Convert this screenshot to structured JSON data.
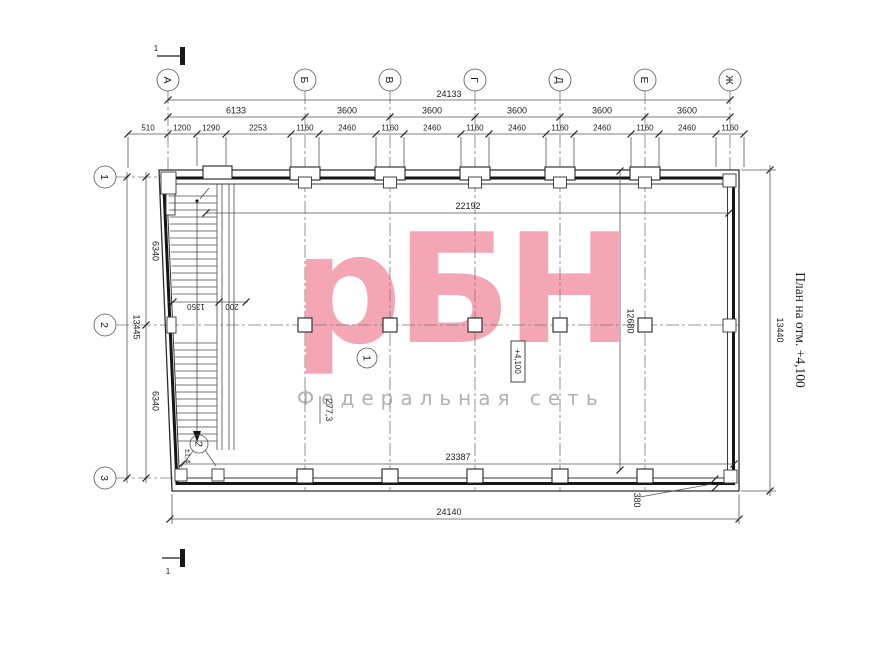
{
  "side_title": "План на отм. +4,100",
  "watermark": {
    "logo": "рБН",
    "subtitle": "Федеральная сеть",
    "logo_color": "#f4a6b5",
    "subtitle_color": "#b2b2b2"
  },
  "axes": {
    "columns": [
      "А",
      "Б",
      "В",
      "Г",
      "Д",
      "Е",
      "Ж"
    ],
    "rows": [
      "1",
      "2",
      "3"
    ]
  },
  "dims": {
    "top_total": "24133",
    "top_spans": [
      "6133",
      "3600",
      "3600",
      "3600",
      "3600",
      "3600"
    ],
    "top_detail": [
      "510",
      "1200",
      "1290",
      "2253",
      "1160",
      "2460",
      "1160",
      "2460",
      "1160",
      "2460",
      "1160",
      "2460",
      "1160",
      "2460",
      "1160"
    ],
    "left_outer": "13445",
    "left_spans": [
      "6340",
      "6340"
    ],
    "right_outer": "13440",
    "top_interior": "22192",
    "mid_vertical": "12680",
    "bottom_interior": "23387",
    "bottom_total": "24140",
    "wall_offset": "380",
    "stair_flight": "1350",
    "stair_gap": "200"
  },
  "marks": {
    "section": "1",
    "room_number": "1",
    "room_area": "277,3",
    "floor_elevation": "+4,100",
    "stair_number": "2",
    "stair_elevation": "±1,4"
  }
}
